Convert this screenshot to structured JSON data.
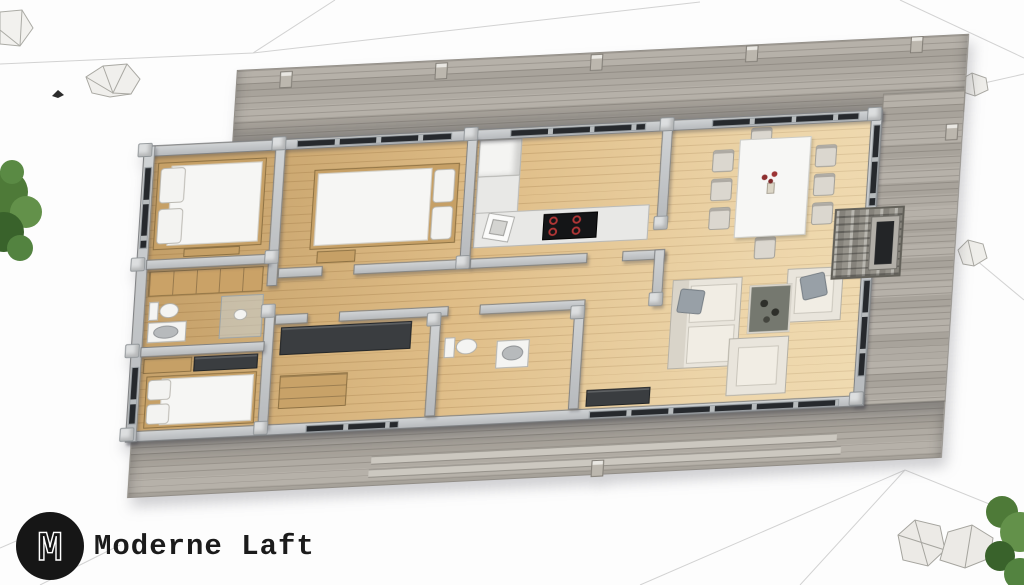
{
  "logo": {
    "monogram": "M",
    "text": "Moderne Laft"
  },
  "scene": {
    "type": "3d-floorplan-render",
    "view": "axonometric cutaway, rotated",
    "rooms": [
      {
        "id": "bedroom-1",
        "furniture": [
          "double-bed",
          "two-pillows",
          "foot-bench"
        ]
      },
      {
        "id": "closet",
        "furniture": [
          "open-wood-shelves"
        ]
      },
      {
        "id": "bathroom-1",
        "furniture": [
          "toilet",
          "vanity-sink",
          "glass-shower"
        ]
      },
      {
        "id": "bedroom-2",
        "furniture": [
          "double-bed",
          "two-pillows",
          "wardrobe-row"
        ]
      },
      {
        "id": "bedroom-3",
        "furniture": [
          "double-bed",
          "two-pillows",
          "foot-chest"
        ]
      },
      {
        "id": "kitchen",
        "furniture": [
          "l-shaped-counter",
          "fridge",
          "corner-sink",
          "cooktop-4-burners"
        ]
      },
      {
        "id": "hallway",
        "furniture": []
      },
      {
        "id": "storage",
        "furniture": [
          "dark-wardrobe",
          "wood-dresser"
        ]
      },
      {
        "id": "bathroom-2",
        "furniture": [
          "toilet",
          "round-sink"
        ]
      },
      {
        "id": "dining-area",
        "furniture": [
          "white-table",
          "eight-chairs",
          "red-flower-centerpiece"
        ]
      },
      {
        "id": "living-room",
        "furniture": [
          "sofa",
          "armchair",
          "armchair",
          "coffee-table",
          "stone-fireplace"
        ]
      },
      {
        "id": "deck",
        "furniture": [
          "posts",
          "stairs"
        ]
      }
    ],
    "environment": [
      "terrain-mesh-lines",
      "rocks",
      "shrub-left",
      "shrub-bottom-right"
    ]
  },
  "palette": {
    "background": "#fdfdfd",
    "deck_plank": "#b0aba3",
    "wood_floor": "#dfbd87",
    "wall_gray": "#c3c6c9",
    "window_glass": "#26292d",
    "furniture_white": "#f6f6f4",
    "sofa_cream": "#e9e5dc",
    "pillow_gray": "#98a0a7",
    "cabinet_wood": "#c6a066",
    "cabinet_dark": "#3a3d40",
    "fireplace_stone": "#96938b",
    "cooktop_burner_red": "#b13636",
    "flower_red": "#8e2f2f",
    "plant_green": "#4e7a38",
    "logo_black": "#161616"
  }
}
